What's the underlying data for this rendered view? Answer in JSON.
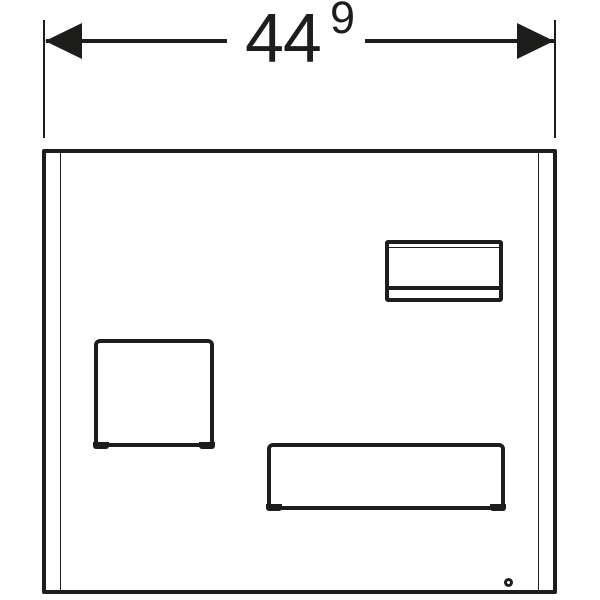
{
  "diagram": {
    "type": "technical-drawing",
    "dimension": {
      "value": "44",
      "superscript": "9"
    },
    "colors": {
      "line": "#1d1d1b",
      "background": "#ffffff"
    }
  }
}
